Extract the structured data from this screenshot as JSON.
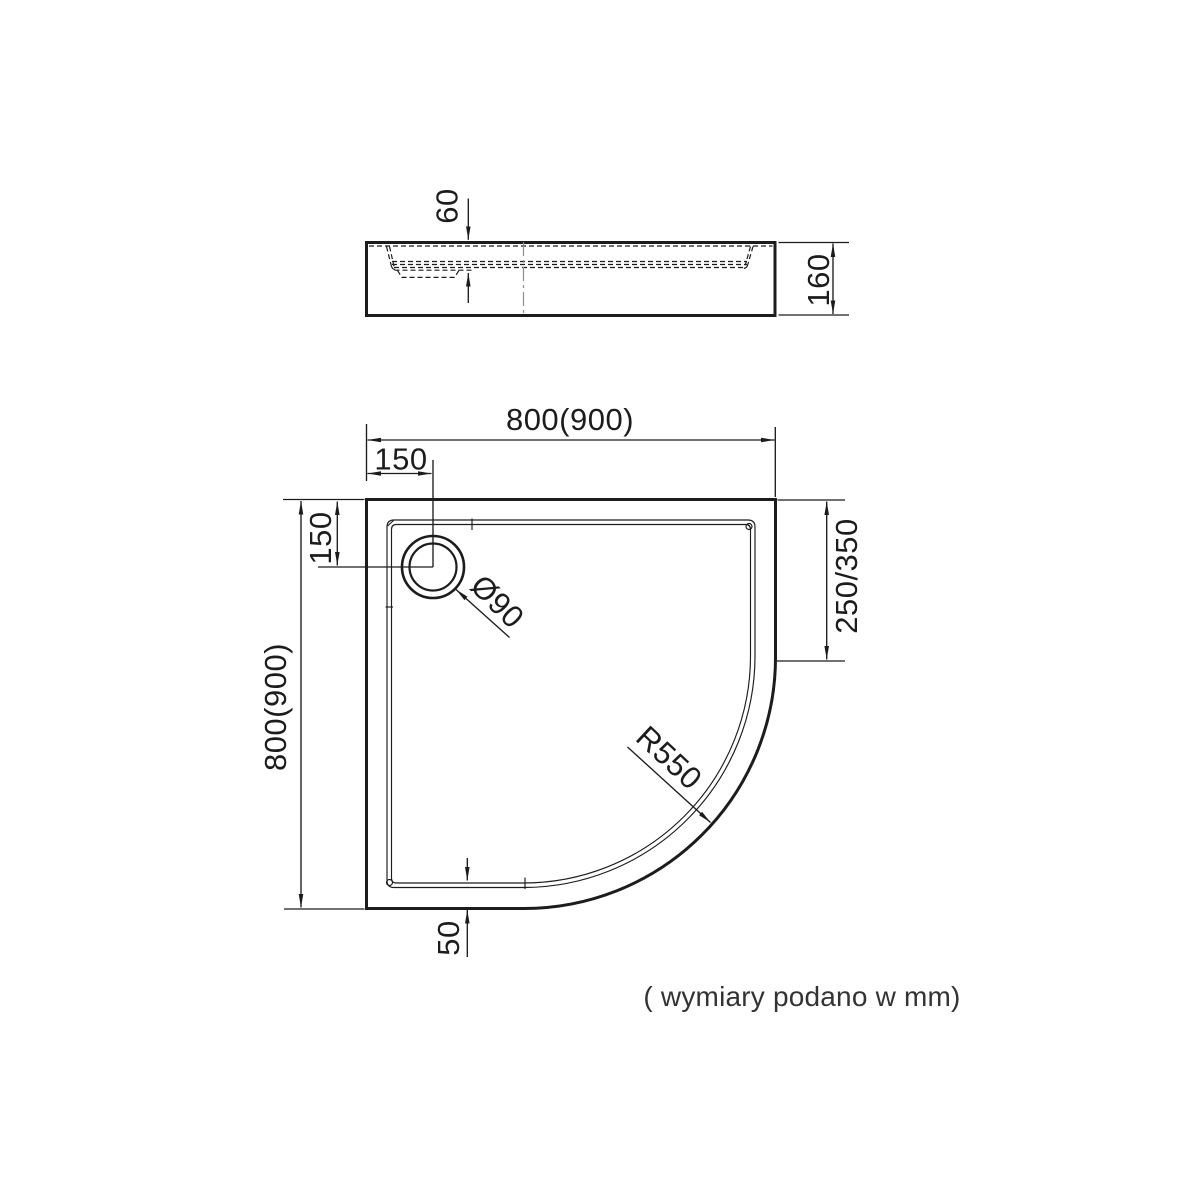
{
  "drawing": {
    "type": "technical-dimension-drawing",
    "subject": "quadrant shower tray (plan view and side view)",
    "units_note": "( wymiary podano w mm)"
  },
  "colors": {
    "line": "#1c1c1c",
    "centerline": "#8f8f8f",
    "note_text": "#333333",
    "background": "#ffffff"
  },
  "side_view": {
    "depth_label": "60",
    "height_label": "160"
  },
  "plan_view": {
    "width_label": "800(900)",
    "height_label": "800(900)",
    "drain_offset_top_label": "150",
    "drain_offset_left_label": "150",
    "right_edge_label": "250/350",
    "drain_diameter_label": "Ø90",
    "corner_radius_label": "R550",
    "bottom_rim_label": "50"
  }
}
